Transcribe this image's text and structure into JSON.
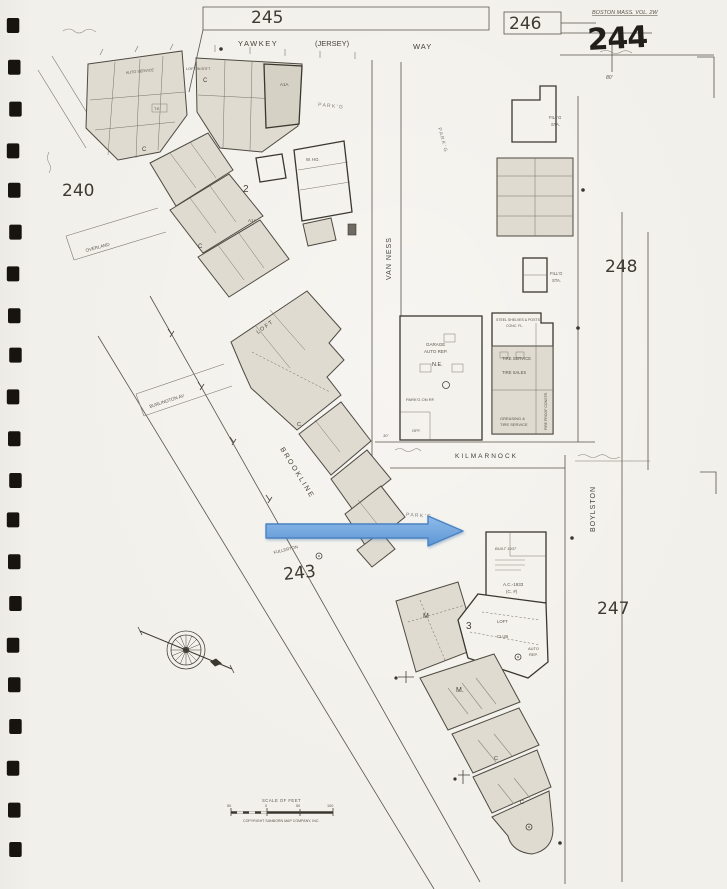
{
  "document": {
    "type": "scanned fire insurance map sheet",
    "volume_note": "BOSTON MASS. VOL. 2W"
  },
  "colors": {
    "paper": "#F1EFE9",
    "ink": "#4E4A42",
    "building_fill": "#DFDBD1",
    "arrow_fill": "#6FA4DF",
    "arrow_stroke": "#4C82C2"
  },
  "binding": {
    "hole_count": 21,
    "hole_color": "#17140f"
  },
  "sheet_numbers": {
    "current": "244",
    "top_left": "245",
    "top_center": "246",
    "west": "240",
    "center": "243",
    "east_upper": "248",
    "east_lower": "247"
  },
  "streets": {
    "yawkey": "YAWKEY",
    "jersey": "(JERSEY)",
    "way": "WAY",
    "van_ness": "VAN NESS",
    "kilmarnock": "KILMARNOCK",
    "boylston": "BOYLSTON",
    "brookline": "BROOKLINE",
    "burlington_av": "BURLINGTON AV",
    "overland": "OVERLAND",
    "fullerton": "FULLERTON"
  },
  "labels": {
    "auto_service": "AUTO SERVICE",
    "loft_bsmt": "LOFT IN B'S'T",
    "c": "C",
    "c_dot": "C.",
    "a1a": "A1A",
    "te": "T.E.",
    "block_2": "2",
    "block_3": "3",
    "m": "M",
    "m_dot": "M.",
    "w_ho": "W. HO.",
    "parkg": "P A R K ' G",
    "loft_spaced": "L O F T",
    "loft": "LOFT",
    "club": "CLUB",
    "garage": "GARAGE",
    "auto_rep": "AUTO REP.",
    "auto": "AUTO",
    "rep": "REP.",
    "ne": "N.E.",
    "parkg_on_rf": "PARK'G ON RF.",
    "off": "OFF.",
    "tire_service": "TIRE SERVICE",
    "tire_sales": "TIRE SALES",
    "greasing": "GREASING &",
    "steel_shelves": "STEEL SHELVES & POSTS",
    "conc_fl": "CONC. FL.",
    "fire_proof": "FIRE PROOF CONSTR.",
    "fillg": "FILL'G",
    "sta": "STA.",
    "built_1937": "BUILT 1937",
    "ac_1933": "A.C.-1933",
    "c_no": "(C. #)",
    "dim_80": "80'",
    "dim_30": "30'"
  },
  "scale_bar": {
    "title": "SCALE OF FEET",
    "tick_50": "50",
    "tick_0": "0",
    "tick_100": "100",
    "copyright": "COPYRIGHT SANBORN MAP COMPANY, INC."
  },
  "overlay": {
    "arrow_fill": "#6FA4DF",
    "arrow_stroke": "#4C82C2"
  }
}
